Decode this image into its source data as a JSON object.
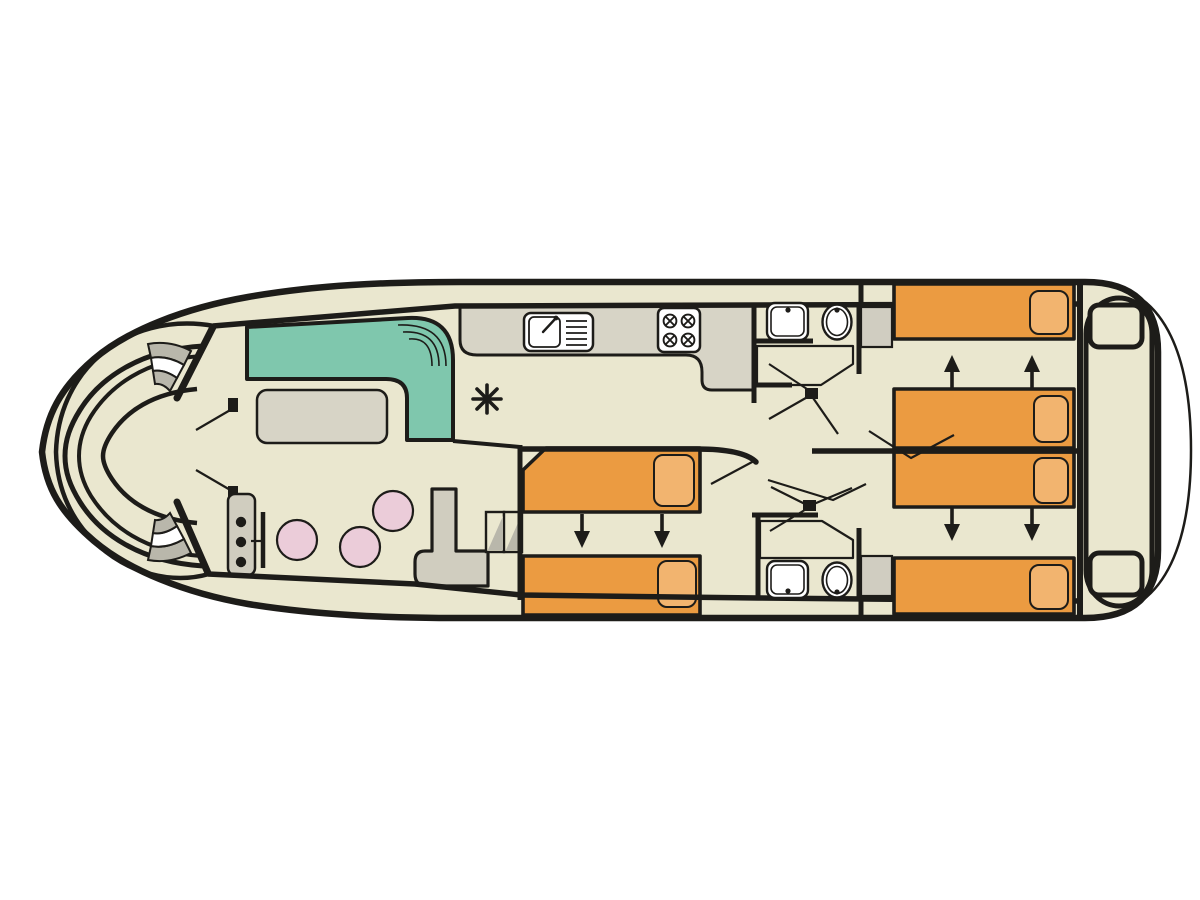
{
  "colors": {
    "canvas": "#ffffff",
    "line": "#1d1c19",
    "hull": "#eae7cf",
    "sofa": "#7fc7ad",
    "bed": "#eb9b41",
    "pillow": "#f2b46f",
    "stool": "#ebccd9",
    "counter": "#d7d4c6",
    "console": "#d0cdbf",
    "step": "#b9b7ab",
    "wardrobe": "#d0cdc1",
    "fixture": "#ffffff"
  },
  "plan": {
    "type": "boat-deck-floorplan",
    "orientation": "bow-left-stern-right",
    "bow": {
      "features": [
        "pointed-bow",
        "curved-bench-seat",
        "side-deck-steps-port",
        "side-deck-steps-starboard",
        "double-entry-doors"
      ]
    },
    "salon": {
      "sofa": "l-shaped-teal-sofa",
      "table": "rectangular-table",
      "stool_count": 3,
      "helm": [
        "instrument-console-3-dials",
        "steering-wheel"
      ]
    },
    "galley": {
      "features": [
        "l-shaped-counter",
        "sink-with-drainer",
        "stove-4-burners",
        "heater-asterisk-symbol"
      ]
    },
    "forward_bathroom": {
      "features": [
        "washbasin",
        "toilet",
        "shower-grid",
        "door-swing"
      ]
    },
    "aft_bathroom": {
      "features": [
        "washbasin",
        "toilet",
        "shower-grid",
        "door-swing"
      ]
    },
    "mid_cabin": {
      "beds": 2,
      "pillows_per_bed": 1,
      "slide_arrows": "down",
      "features": [
        "companionway-steps",
        "sliding-twin-beds"
      ]
    },
    "stern_cabin_port": {
      "beds": 2,
      "slide_arrows": "up",
      "features": [
        "wardrobe",
        "sliding-twin-beds"
      ]
    },
    "stern_cabin_starboard": {
      "beds": 2,
      "slide_arrows": "down",
      "features": [
        "wardrobe",
        "sliding-twin-beds"
      ]
    },
    "stern": {
      "features": [
        "aft-deck-well",
        "boarding-step-port",
        "boarding-step-starboard",
        "swim-platform"
      ]
    }
  }
}
